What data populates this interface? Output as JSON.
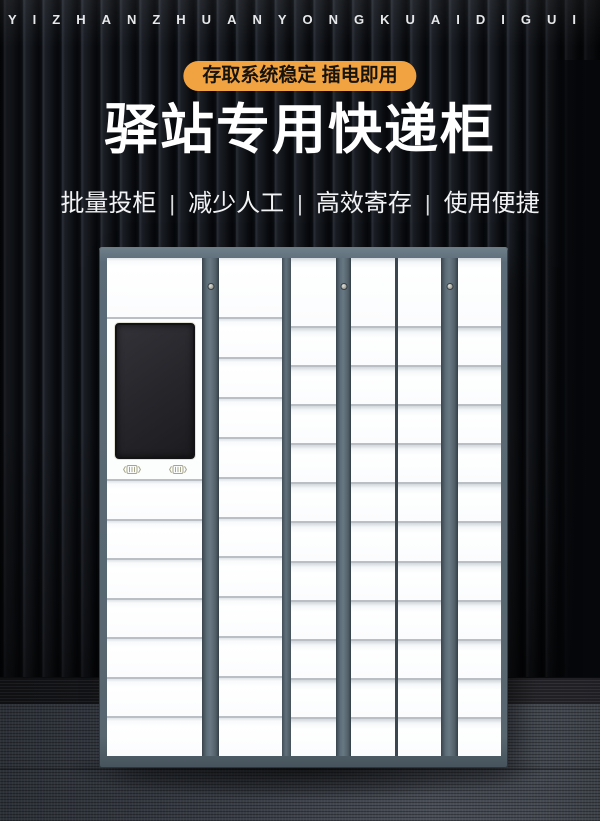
{
  "poster": {
    "pinyin_banner": "YIZHANZHUANYONGKUAIDIGUI",
    "badge_text": "存取系统稳定 插电即用",
    "title": "驿站专用快递柜",
    "features": [
      "批量投柜",
      "减少人工",
      "高效寄存",
      "使用便捷"
    ],
    "separator": "|"
  },
  "colors": {
    "badge_bg": "#F2A341",
    "badge_text": "#17130D",
    "title_text": "#FFFFFF",
    "feature_text": "#F2F3F4",
    "cabinet_frame": "#5B6B77",
    "locker_door": "#FBFCFD",
    "door_gap": "#B9BFC5",
    "screen_bg": "#232327",
    "scanner_icon": "#A6A68A",
    "wall_dark": "#0A0C10",
    "carpet": "#3F444C"
  },
  "cabinet": {
    "scanner_icon_count": 2,
    "columns": [
      {
        "id": "main",
        "type": "main",
        "top_cells": 1,
        "lower_cells": 7,
        "has_screen": true
      },
      {
        "id": "col-2",
        "type": "single",
        "cells": 12
      },
      {
        "id": "col-3",
        "type": "single",
        "cells": 12
      },
      {
        "id": "col-4",
        "type": "single",
        "cells": 12
      },
      {
        "id": "col-5",
        "type": "single",
        "cells": 12
      },
      {
        "id": "col-6",
        "type": "single",
        "cells": 12
      }
    ]
  }
}
